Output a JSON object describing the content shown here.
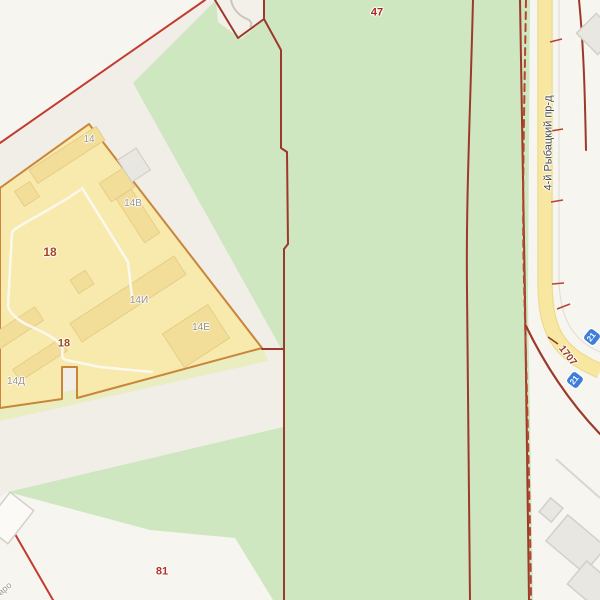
{
  "map": {
    "kind": "cadastral-map",
    "colors": {
      "bg": "#f7f5f0",
      "strip": "#f0eee6",
      "notch": "#f2f0e9",
      "green": "#cfe7c0",
      "band": "#e9edc0",
      "yellow": "#f8e9ad",
      "yellowline": "#c9853a",
      "bldg": "#f2dd99",
      "bldgline": "#e5cf8a",
      "redline": "#9d392b",
      "redbright": "#c23b2e",
      "reddash": "#b5452e",
      "road": "#f8e7a0",
      "roadedge": "#ecdb90",
      "badge": "#3d7ed8",
      "gray": "#d9d6cd",
      "graybldg": "#e9e7e1",
      "graybldgline": "#d3d0c8",
      "whitebldg": "#fbfaf6",
      "path": "#c9c6bd",
      "driveway": "#fbf9ee"
    },
    "labels": [
      {
        "name": "parcel-label-47",
        "text": "47",
        "x": 377,
        "y": 13,
        "size": 11,
        "color": "#a5281e",
        "bold": true
      },
      {
        "name": "parcel-label-18",
        "text": "18",
        "x": 50,
        "y": 252,
        "size": 12,
        "color": "#a04a1a",
        "bold": true
      },
      {
        "name": "parcel-label-18-south",
        "text": "18",
        "x": 64,
        "y": 344,
        "size": 11,
        "color": "#a04a1a",
        "bold": true
      },
      {
        "name": "parcel-label-81",
        "text": "81",
        "x": 162,
        "y": 572,
        "size": 11,
        "color": "#b5322a",
        "bold": true
      },
      {
        "name": "building-label-14",
        "text": "14",
        "x": 89,
        "y": 140,
        "size": 10,
        "color": "#9d978b",
        "bold": false
      },
      {
        "name": "building-label-14v",
        "text": "14В",
        "x": 133,
        "y": 204,
        "size": 10,
        "color": "#9d978b",
        "bold": false
      },
      {
        "name": "building-label-14i",
        "text": "14И",
        "x": 139,
        "y": 301,
        "size": 10,
        "color": "#9a8f7c",
        "bold": false
      },
      {
        "name": "building-label-14e",
        "text": "14Е",
        "x": 201,
        "y": 328,
        "size": 10,
        "color": "#9a8f7c",
        "bold": false
      },
      {
        "name": "building-label-14d",
        "text": "14Д",
        "x": 16,
        "y": 382,
        "size": 10,
        "color": "#9d978b",
        "bold": false
      },
      {
        "name": "street-name-rybatsky",
        "text": "4-й Рыбацкий пр-д",
        "x": 549,
        "y": 143,
        "size": 11,
        "color": "#4b4b47",
        "rot": -90,
        "bold": false
      },
      {
        "name": "road-number-1707",
        "text": "1707",
        "x": 567,
        "y": 356,
        "size": 10,
        "color": "#8d3a28",
        "rot": 52,
        "bold": true
      },
      {
        "name": "map-edge-text-fragment",
        "text": "аро",
        "x": 5,
        "y": 589,
        "size": 9,
        "color": "#9d978b",
        "rot": -40,
        "bold": false
      }
    ],
    "badges": [
      {
        "name": "route-badge-21-upper",
        "text": "21",
        "x": 592,
        "y": 337,
        "rot": 38
      },
      {
        "name": "route-badge-21-lower",
        "text": "21",
        "x": 575,
        "y": 380,
        "rot": 38
      }
    ]
  }
}
